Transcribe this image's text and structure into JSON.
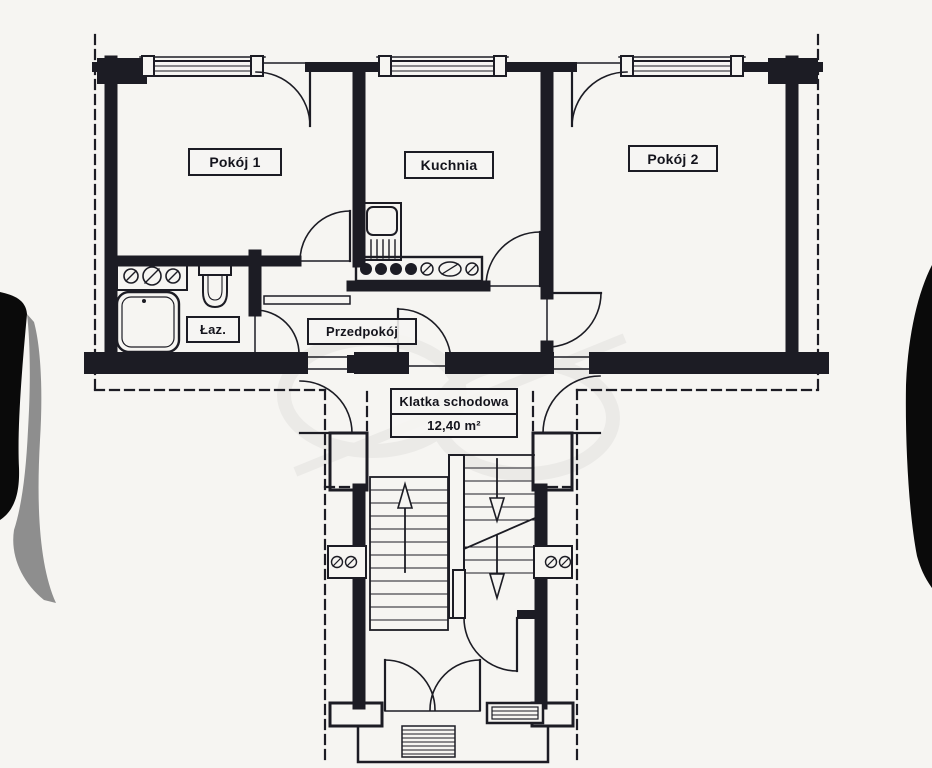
{
  "document_type": "apartment floor plan",
  "colors": {
    "paper": "#f6f5f2",
    "ink": "#1c1c24",
    "photo_edge": "#0a0a0a",
    "page_curl_shadow": "#8e8e8e"
  },
  "rooms": {
    "pokoj1": {
      "label": "Pokój 1"
    },
    "kuchnia": {
      "label": "Kuchnia"
    },
    "pokoj2": {
      "label": "Pokój 2"
    },
    "lazienka": {
      "label": "Łaz."
    },
    "przedpokoj": {
      "label": "Przedpokój"
    },
    "klatka_schodowa": {
      "label": "Klatka schodowa",
      "area": "12,40 m²"
    }
  }
}
